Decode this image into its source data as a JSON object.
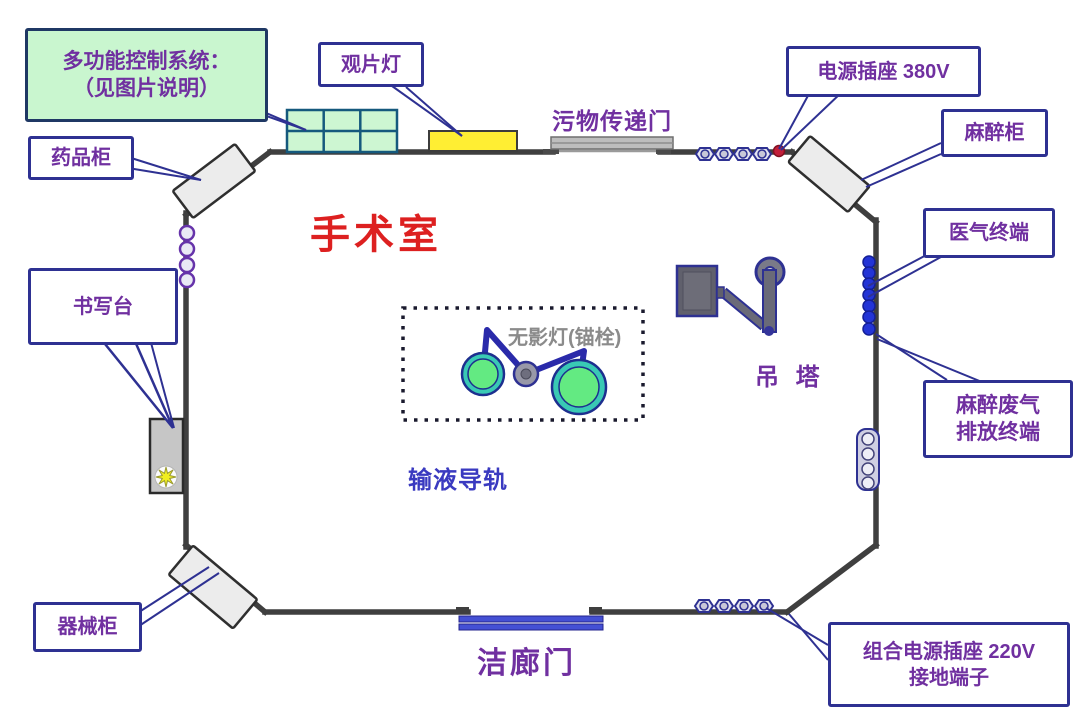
{
  "diagram": {
    "room_title": "手术室",
    "annotations": {
      "control_system_line1": "多功能控制系统：",
      "control_system_line2": "（见图片说明）",
      "film_lamp": "观片灯",
      "medicine_cabinet": "药品柜",
      "waste_transfer_door": "污物传递门",
      "power_socket_380v": "电源插座  380V",
      "anesthesia_cabinet": "麻醉柜",
      "medical_gas_terminal": "医气终端",
      "writing_desk": "书写台",
      "shadowless_lamp": "无影灯(锚栓)",
      "ceiling_pendant": "吊 塔",
      "anesthesia_waste_gas_line1": "麻醉废气",
      "anesthesia_waste_gas_line2": "排放终端",
      "infusion_rail": "输液导轨",
      "instrument_cabinet": "器械柜",
      "clean_corridor_door": "洁廊门",
      "combo_socket_line1": "组合电源插座  220V",
      "combo_socket_line2": "接地端子"
    },
    "colors": {
      "wall": "#3f3f3f",
      "label_text": "#7030a0",
      "label_border": "#2e3192",
      "room_title_red": "#dd2020",
      "control_box_green": "#c9f6cf",
      "film_lamp_yellow": "#ffee33",
      "gas_terminal_blue": "#2334d6",
      "lamp_green": "#63ea82",
      "lamp_teal": "#39c9b4",
      "infusion_rail_blue": "#3a3ac0",
      "annotation_gray": "#8b8b8b",
      "socket_red_dot": "#c21f3a",
      "clean_door_blue": "#4450d4"
    }
  }
}
